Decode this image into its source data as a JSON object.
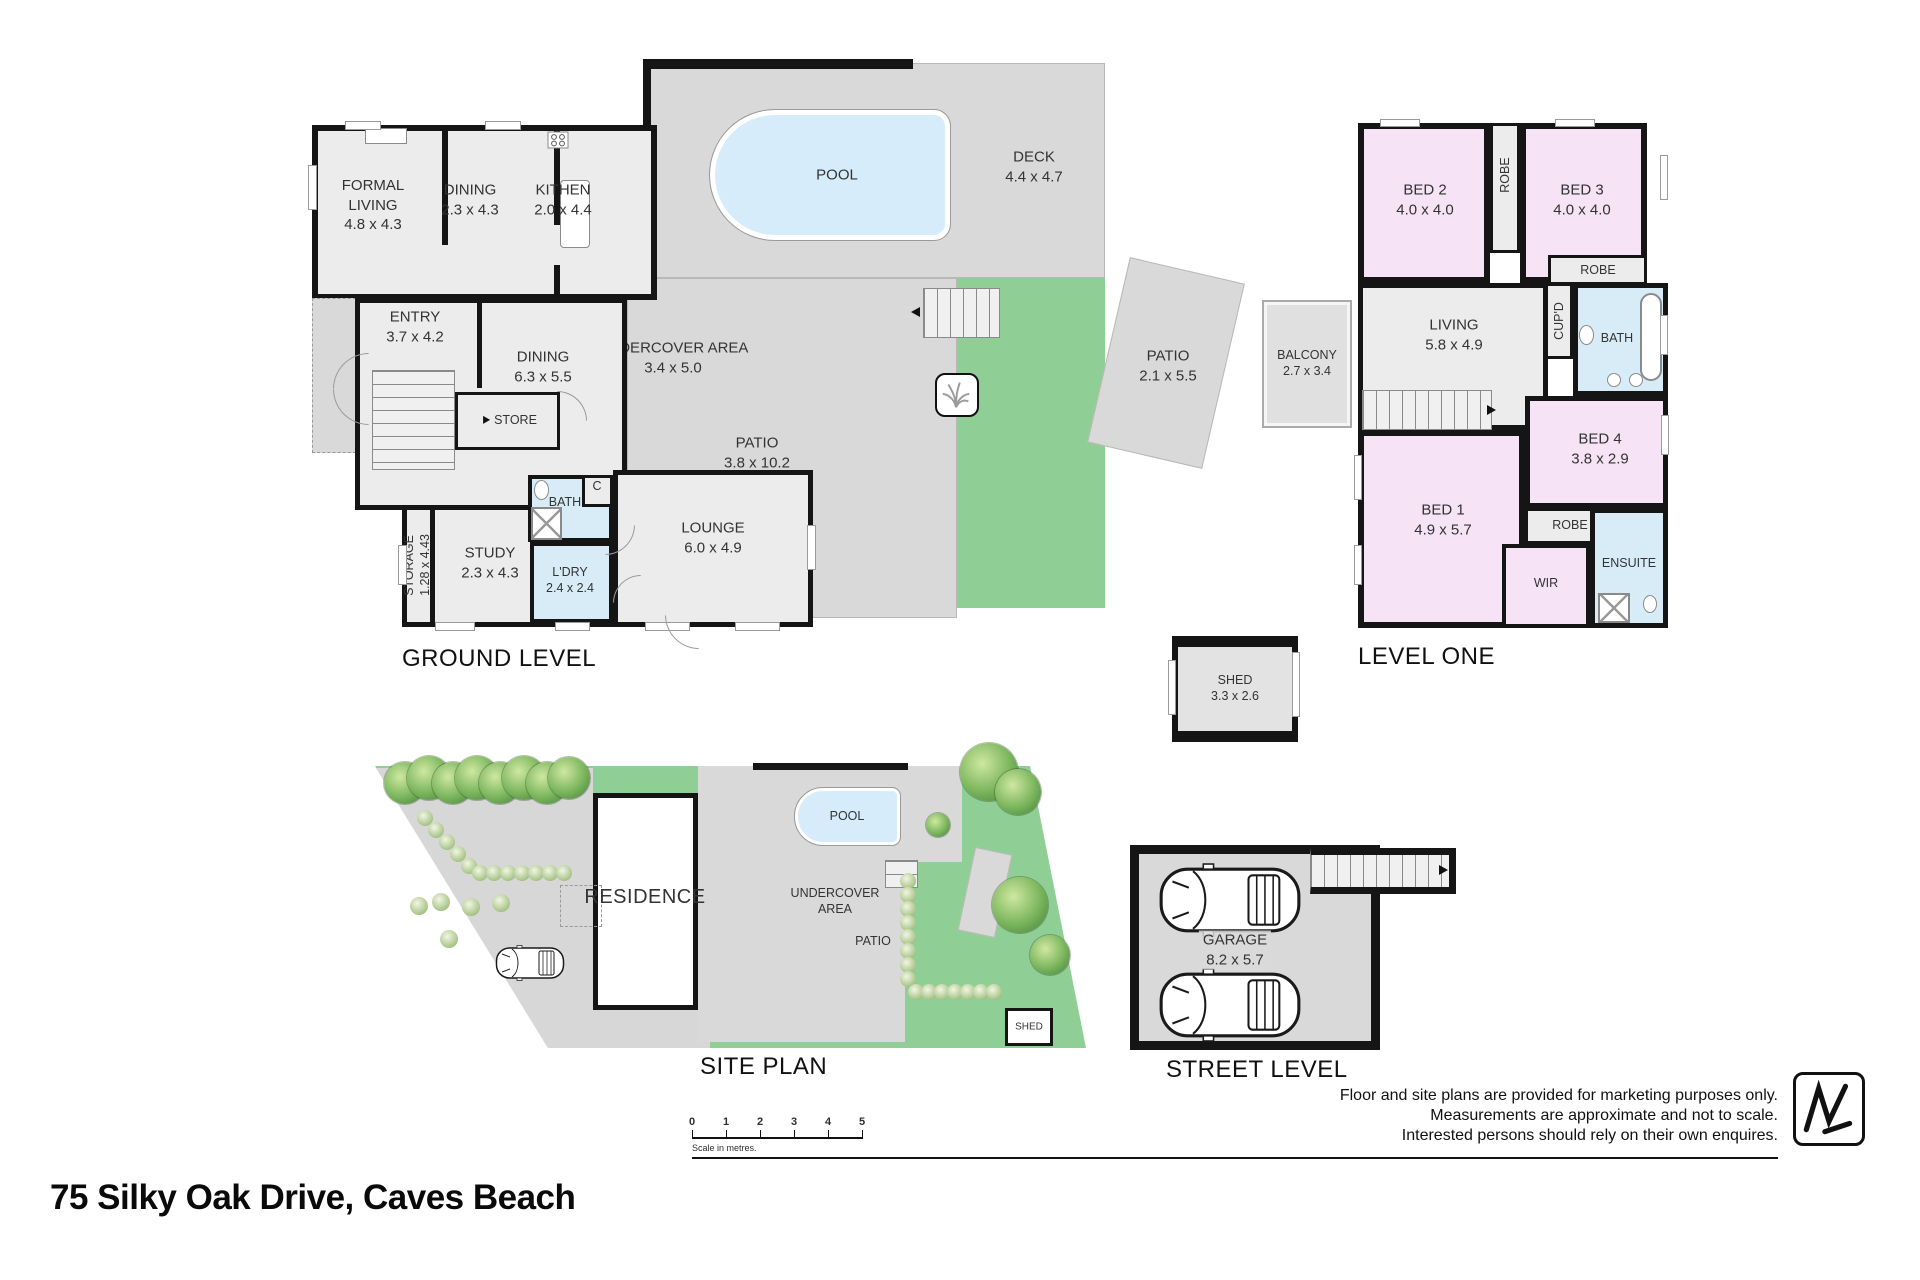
{
  "address": "75 Silky Oak Drive, Caves Beach",
  "ground": {
    "title": "GROUND LEVEL",
    "rooms": {
      "formal_living": {
        "name": "FORMAL LIVING",
        "dims": "4.8 x 4.3"
      },
      "dining_a": {
        "name": "DINING",
        "dims": "2.3 x 4.3"
      },
      "kitchen": {
        "name": "KITHEN",
        "dims": "2.0 x 4.4"
      },
      "pool": {
        "name": "POOL"
      },
      "deck": {
        "name": "DECK",
        "dims": "4.4 x 4.7"
      },
      "entry": {
        "name": "ENTRY",
        "dims": "3.7 x 4.2"
      },
      "dining_b": {
        "name": "DINING",
        "dims": "6.3 x 5.5"
      },
      "undercover": {
        "name": "UNDERCOVER AREA",
        "dims": "3.4 x 5.0"
      },
      "store": {
        "name": "STORE"
      },
      "patio_main": {
        "name": "PATIO",
        "dims": "3.8 x 10.2"
      },
      "patio_detached": {
        "name": "PATIO",
        "dims": "2.1 x 5.5"
      },
      "bath": {
        "name": "BATH"
      },
      "closet": {
        "name": "C"
      },
      "storage": {
        "name": "STORAGE",
        "dims": "1.28 x 4.43"
      },
      "study": {
        "name": "STUDY",
        "dims": "2.3 x 4.3"
      },
      "laundry": {
        "name": "L'DRY",
        "dims": "2.4 x 2.4"
      },
      "lounge": {
        "name": "LOUNGE",
        "dims": "6.0 x 4.9"
      }
    }
  },
  "level_one": {
    "title": "LEVEL ONE",
    "rooms": {
      "balcony": {
        "name": "BALCONY",
        "dims": "2.7 x 3.4"
      },
      "bed2": {
        "name": "BED 2",
        "dims": "4.0 x 4.0"
      },
      "robe_a": {
        "name": "ROBE"
      },
      "bed3": {
        "name": "BED 3",
        "dims": "4.0 x 4.0"
      },
      "robe_b": {
        "name": "ROBE"
      },
      "living": {
        "name": "LIVING",
        "dims": "5.8 x 4.9"
      },
      "cupboard": {
        "name": "CUP'D"
      },
      "bath": {
        "name": "BATH"
      },
      "bed4": {
        "name": "BED 4",
        "dims": "3.8 x 2.9"
      },
      "bed1": {
        "name": "BED 1",
        "dims": "4.9 x 5.7"
      },
      "robe_c": {
        "name": "ROBE"
      },
      "wir": {
        "name": "WIR"
      },
      "ensuite": {
        "name": "ENSUITE"
      }
    }
  },
  "shed_plan": {
    "name": "SHED",
    "dims": "3.3 x 2.6"
  },
  "site": {
    "title": "SITE PLAN",
    "labels": {
      "residence": "RESIDENCE",
      "pool": "POOL",
      "undercover": "UNDERCOVER AREA",
      "patio": "PATIO",
      "shed": "SHED"
    }
  },
  "street": {
    "title": "STREET LEVEL",
    "garage": {
      "name": "GARAGE",
      "dims": "8.2 x 5.7"
    }
  },
  "scale_bar": {
    "ticks": [
      "0",
      "1",
      "2",
      "3",
      "4",
      "5"
    ],
    "caption": "Scale in metres."
  },
  "disclaimer": {
    "line1": "Floor and site plans are provided for marketing purposes only.",
    "line2": "Measurements are approximate and not to scale.",
    "line3": "Interested persons should rely on their own enquires."
  },
  "colors": {
    "grass": "#8fce94",
    "bedroom": "#f6e3f5",
    "wet_area": "#d8ecf7",
    "pool": "#d6ecfa",
    "outdoor": "#d9d9d9",
    "interior": "#ececec",
    "wall": "#151515"
  }
}
